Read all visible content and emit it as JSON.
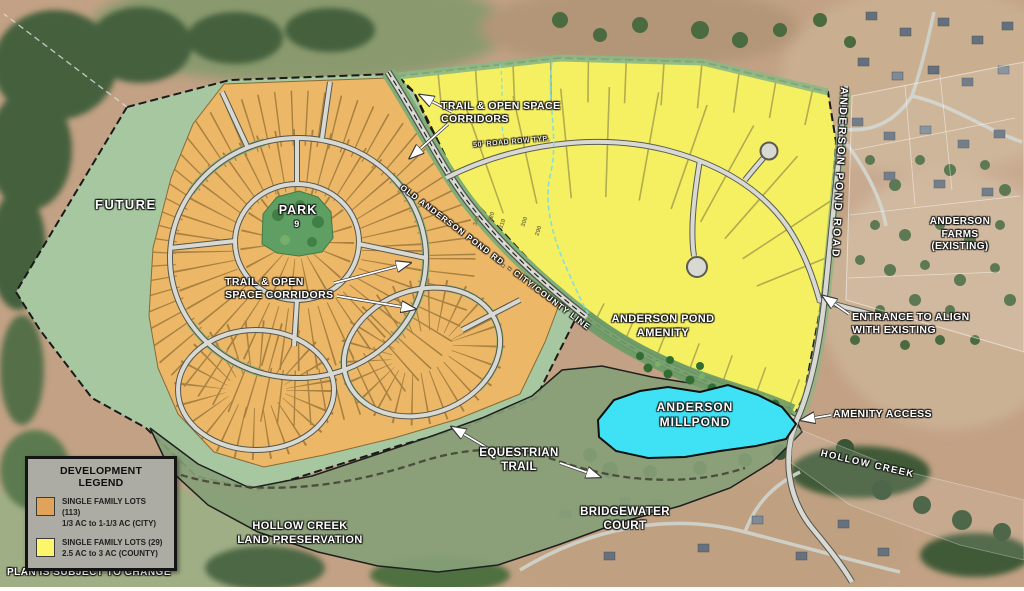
{
  "map": {
    "labels": {
      "trail_corridors_top": "TRAIL & OPEN SPACE\nCORRIDORS",
      "future": "FUTURE",
      "park": "PARK",
      "park_number": "9",
      "trail_corridors_mid": "TRAIL & OPEN\nSPACE CORRIDORS",
      "anderson_pond_amenity": "ANDERSON POND\nAMENITY",
      "anderson_millpond": "ANDERSON\nMILLPOND",
      "equestrian_trail": "EQUESTRIAN\nTRAIL",
      "hollow_creek_land": "HOLLOW CREEK\nLAND PRESERVATION",
      "bridgewater_court": "BRIDGEWATER\nCOURT",
      "hollow_creek": "HOLLOW CREEK",
      "amenity_access": "AMENITY ACCESS",
      "entrance": "ENTRANCE TO ALIGN\nWITH EXISTING",
      "anderson_farms": "ANDERSON FARMS\n(EXISTING)",
      "anderson_pond_road": "ANDERSON POND ROAD",
      "road_row": "50' ROAD ROW TYP.",
      "old_anderson_rd": "OLD ANDERSON POND RD. - CITY/COUNTY LINE",
      "plan_note": "PLAN IS SUBJECT TO CHANGE"
    },
    "contour_labels": [
      "340",
      "320",
      "310",
      "300",
      "290"
    ]
  },
  "legend": {
    "title": "DEVELOPMENT LEGEND",
    "items": [
      {
        "swatch": "#dfa35a",
        "line1": "SINGLE FAMILY LOTS (113)",
        "line2": "1/3 AC to  1-1/3 AC (CITY)"
      },
      {
        "swatch": "#fcf76a",
        "line1": "SINGLE FAMILY LOTS (29)",
        "line2": "2.5 AC to 3 AC (COUNTY)"
      }
    ]
  },
  "colors": {
    "lots_city": "#ECB766",
    "lots_county": "#F5EF62",
    "open_space": "#A6C7A0",
    "preservation": "#87A078",
    "pond": "#3FE2F4",
    "park": "#5F9F63",
    "road": "#D7D9D2",
    "legend_bg": "#ACACA4"
  }
}
